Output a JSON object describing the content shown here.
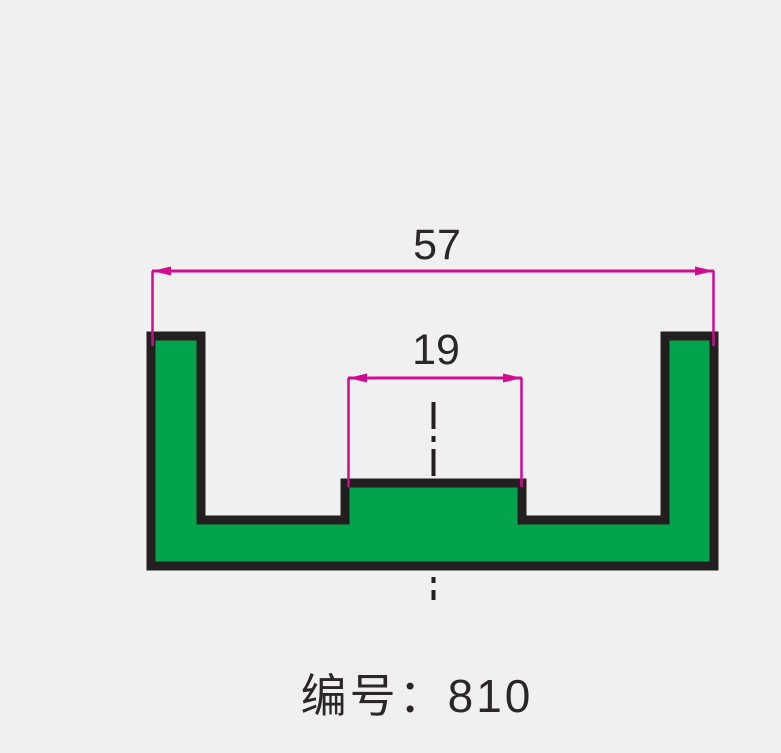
{
  "page": {
    "background_color": "#f1f0f0",
    "kind": "technical drawing of extrusion profile cross-section"
  },
  "profile": {
    "description": "U-channel profile with raised center boss",
    "fill_color": "#00a44c",
    "outline_color": "#231f20"
  },
  "centerline": {
    "style": "dash-dot",
    "color": "#231f20"
  },
  "dimensions": {
    "color": "#d20a8f",
    "overall_width": {
      "value": "57",
      "measures": "overall outer width"
    },
    "boss_width": {
      "value": "19",
      "measures": "center boss width"
    }
  },
  "caption": {
    "text": "编号：810",
    "color": "#2b2727"
  }
}
